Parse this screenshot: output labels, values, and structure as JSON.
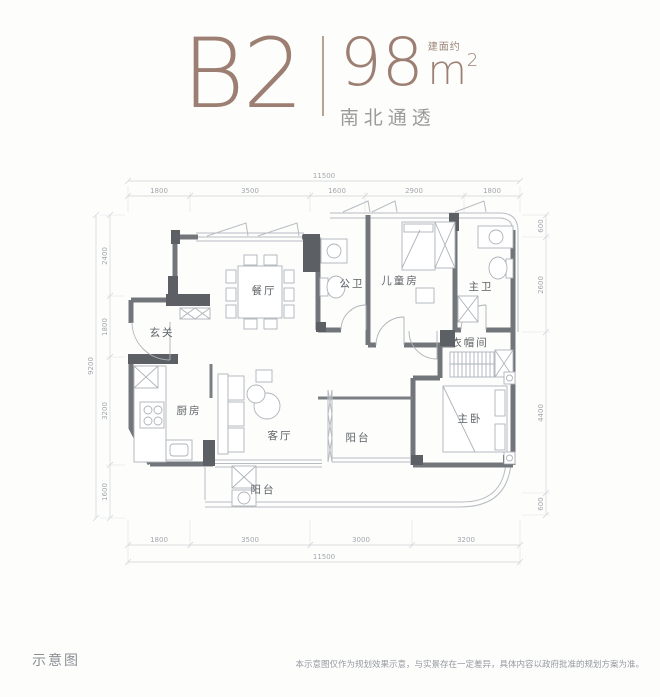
{
  "header": {
    "unit": "B2",
    "area": "98",
    "area_unit_base": "m",
    "area_unit_exp": "2",
    "area_prefix": "建面约",
    "orientation": "南北通透"
  },
  "plan": {
    "rooms": {
      "foyer": "玄关",
      "dining": "餐厅",
      "kitchen": "厨房",
      "living": "客厅",
      "public_bath": "公卫",
      "kids_room": "儿童房",
      "master_bath": "主卫",
      "cloakroom": "衣帽间",
      "master_bedroom": "主卧",
      "balcony_east": "阳台",
      "balcony_south": "阳台"
    },
    "dimensions": {
      "top_total": "11500",
      "top_segments": [
        "1800",
        "3500",
        "1600",
        "2900",
        "1800"
      ],
      "bottom_segments": [
        "1800",
        "3500",
        "3000",
        "3200"
      ],
      "bottom_total": "11500",
      "left_total": "9200",
      "left_segments": [
        "2400",
        "1800",
        "3200",
        "1600"
      ],
      "right_segments": [
        "600",
        "2600",
        "4400",
        "600"
      ]
    }
  },
  "footer": {
    "label": "示意图",
    "disclaimer": "本示意图仅作为规划效果示意，与实景存在一定差异，具体内容以政府批准的规划方案为准。"
  },
  "colors": {
    "accent": "#9c7f72",
    "wall": "#72767b",
    "line": "#b7bcc2",
    "dim_text": "#a2a7ad"
  }
}
